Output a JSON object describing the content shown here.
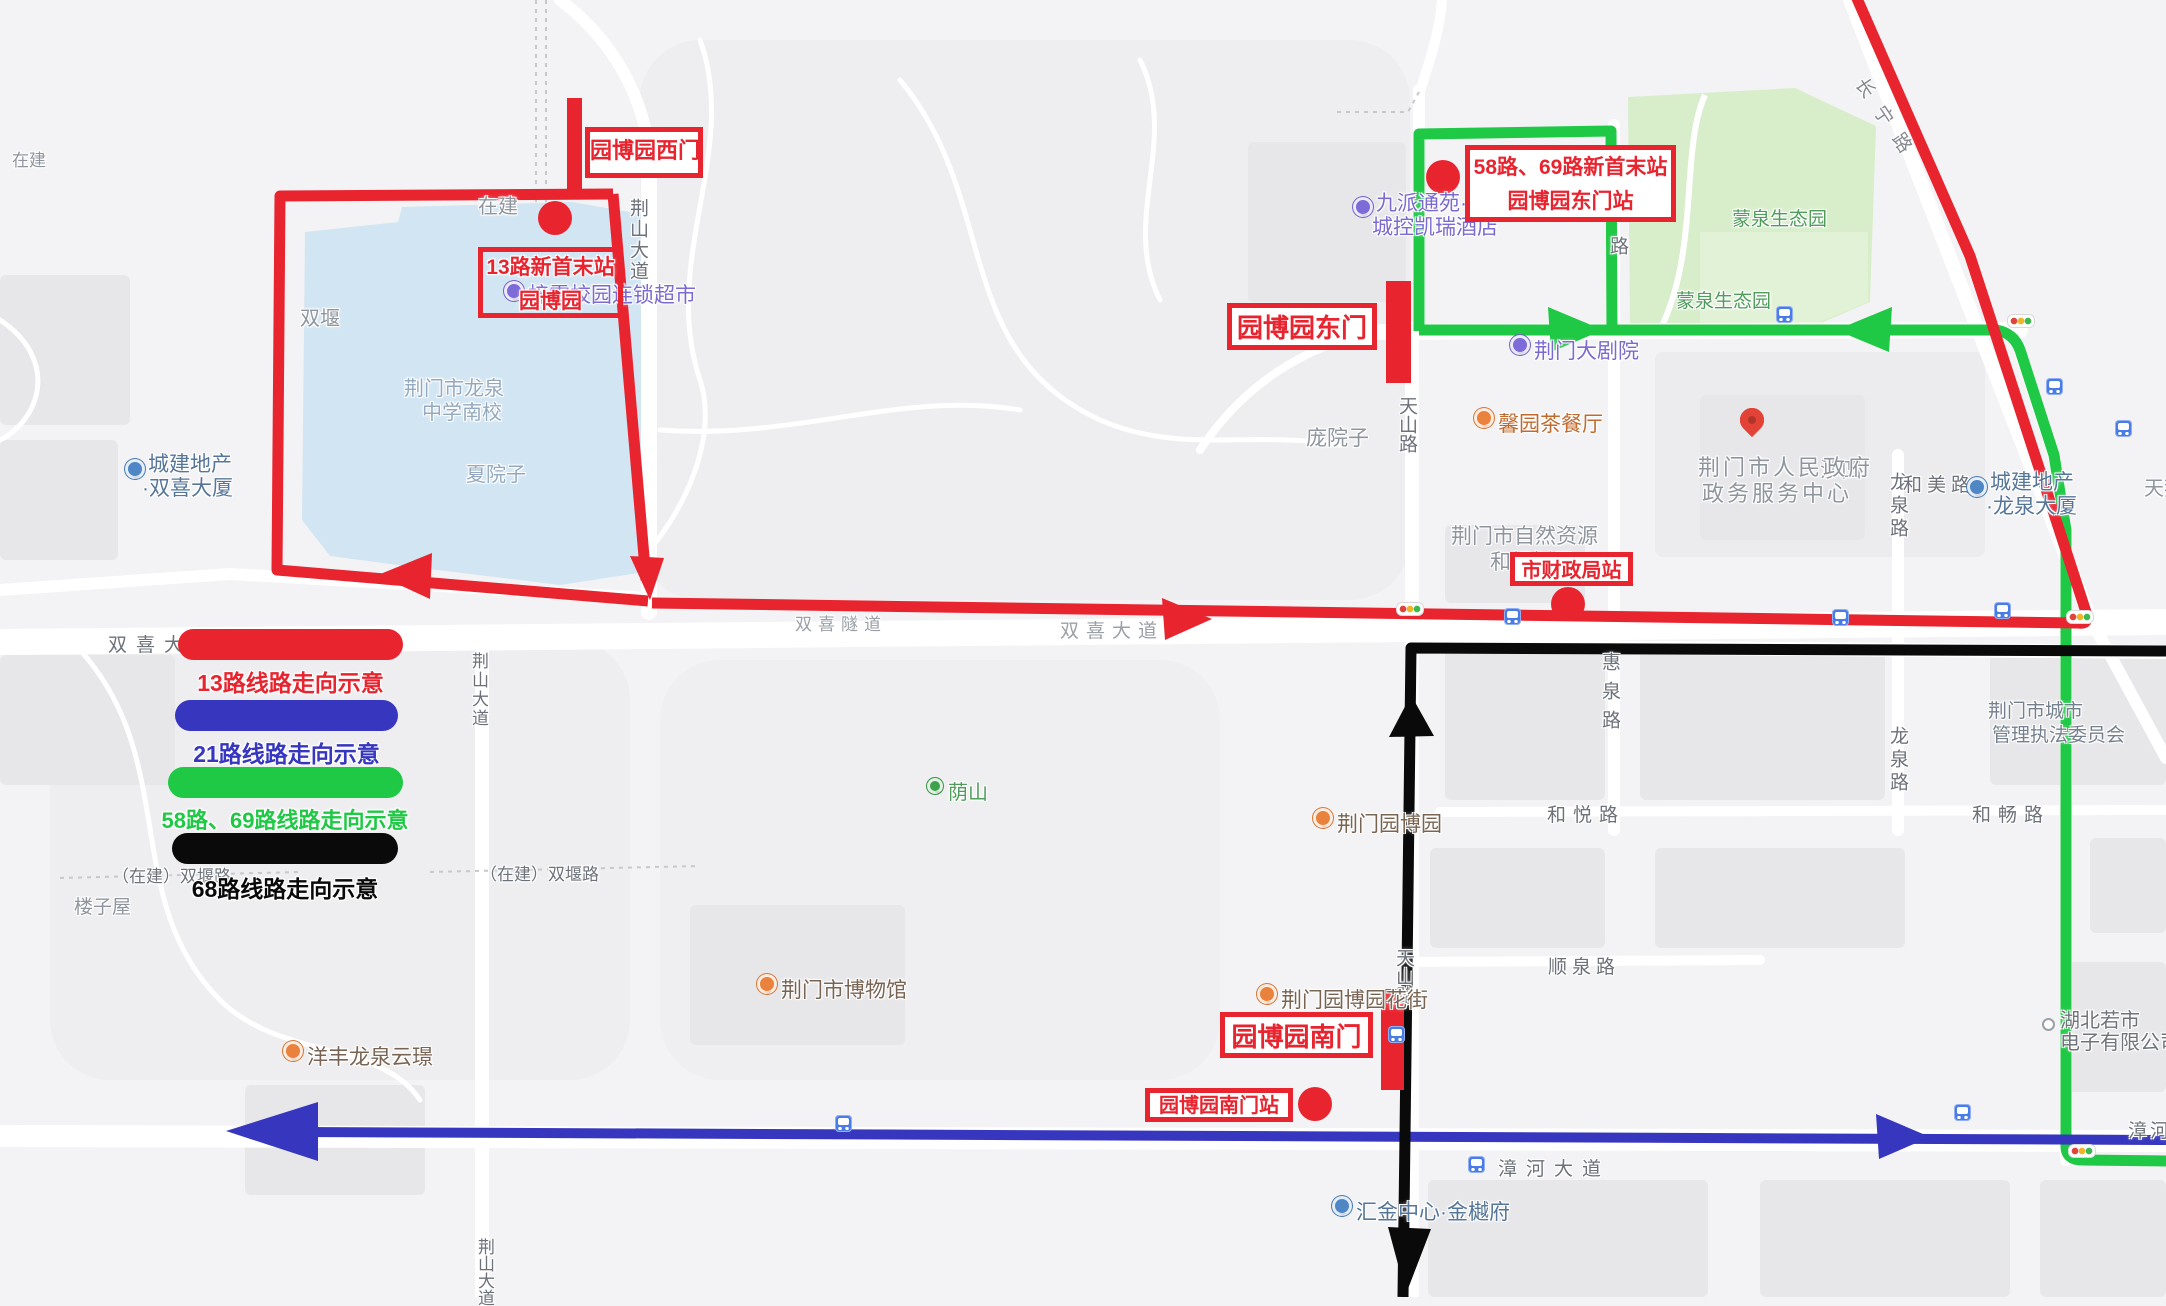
{
  "legend": {
    "items": [
      {
        "label": "13路线路走向示意",
        "color": "#e8242f"
      },
      {
        "label": "21路线路走向示意",
        "color": "#3636bf"
      },
      {
        "label": "58路、69路线路走向示意",
        "color": "#1fc845"
      },
      {
        "label": "68路线路走向示意",
        "color": "#0a0a0a"
      }
    ]
  },
  "routes": [
    {
      "name": "13路",
      "color": "#e8242f"
    },
    {
      "name": "21路",
      "color": "#3636bf"
    },
    {
      "name": "58路、69路",
      "color": "#1fc845"
    },
    {
      "name": "68路",
      "color": "#0a0a0a"
    }
  ],
  "gates": {
    "west": "园博园西门",
    "east": "园博园东门",
    "south": "园博园南门"
  },
  "stations": {
    "s13_line1": "13路新首末站",
    "s13_line2": "园博园",
    "s5869_line1": "58路、69路新首末站",
    "s5869_line2": "园博园东门站",
    "caizheng": "市财政局站",
    "nanmen_stop": "园博园南门站"
  },
  "pois": [
    {
      "line1": "城建地产",
      "line2": "·双喜大厦"
    },
    {
      "line1": "城建地产",
      "line2": "·龙泉大厦"
    },
    {
      "line1": "九派通苑·",
      "line2": "城控凯瑞酒店"
    },
    {
      "name": "梓雯校园连锁超市"
    },
    {
      "name": "荆门大剧院"
    },
    {
      "name": "馨园茶餐厅"
    },
    {
      "name": "荆门市博物馆"
    },
    {
      "name": "荆门园博园"
    },
    {
      "name": "荆门园博园花街"
    },
    {
      "name": "洋丰龙泉云璟"
    },
    {
      "name": "荫山"
    },
    {
      "name": "汇金中心·金樾府"
    },
    {
      "line1": "荆门市人民政府",
      "line2": "政务服务中心"
    },
    {
      "line1": "荆门市城市",
      "line2": "管理执法委员会"
    },
    {
      "line1": "湖北若市",
      "line2": "电子有限公司"
    },
    {
      "line1": "荆门市自然资源",
      "line2": "和规划局"
    }
  ],
  "area_labels": [
    "在建",
    "在建",
    "双堰",
    "庞院子",
    "夏院子",
    "楼子屋",
    "沙凹",
    "蒙泉生态园",
    "蒙泉生态园",
    "天鹅广场"
  ],
  "lake_label": {
    "line1": "荆门市龙泉",
    "line2": "中学南校"
  },
  "road_labels": [
    "双喜大道",
    "双喜隧道",
    "双喜大道",
    "荆山大道",
    "荆山大道",
    "荆山大道",
    "天山路",
    "天山路",
    "惠泉路",
    "惠泉路",
    "龙泉路",
    "龙泉路",
    "和美路",
    "和悦路",
    "和畅路",
    "顺泉路",
    "漳河大道",
    "漳河大道",
    "长宁路",
    "（在建）双堰路",
    "（在建）双堰路"
  ]
}
